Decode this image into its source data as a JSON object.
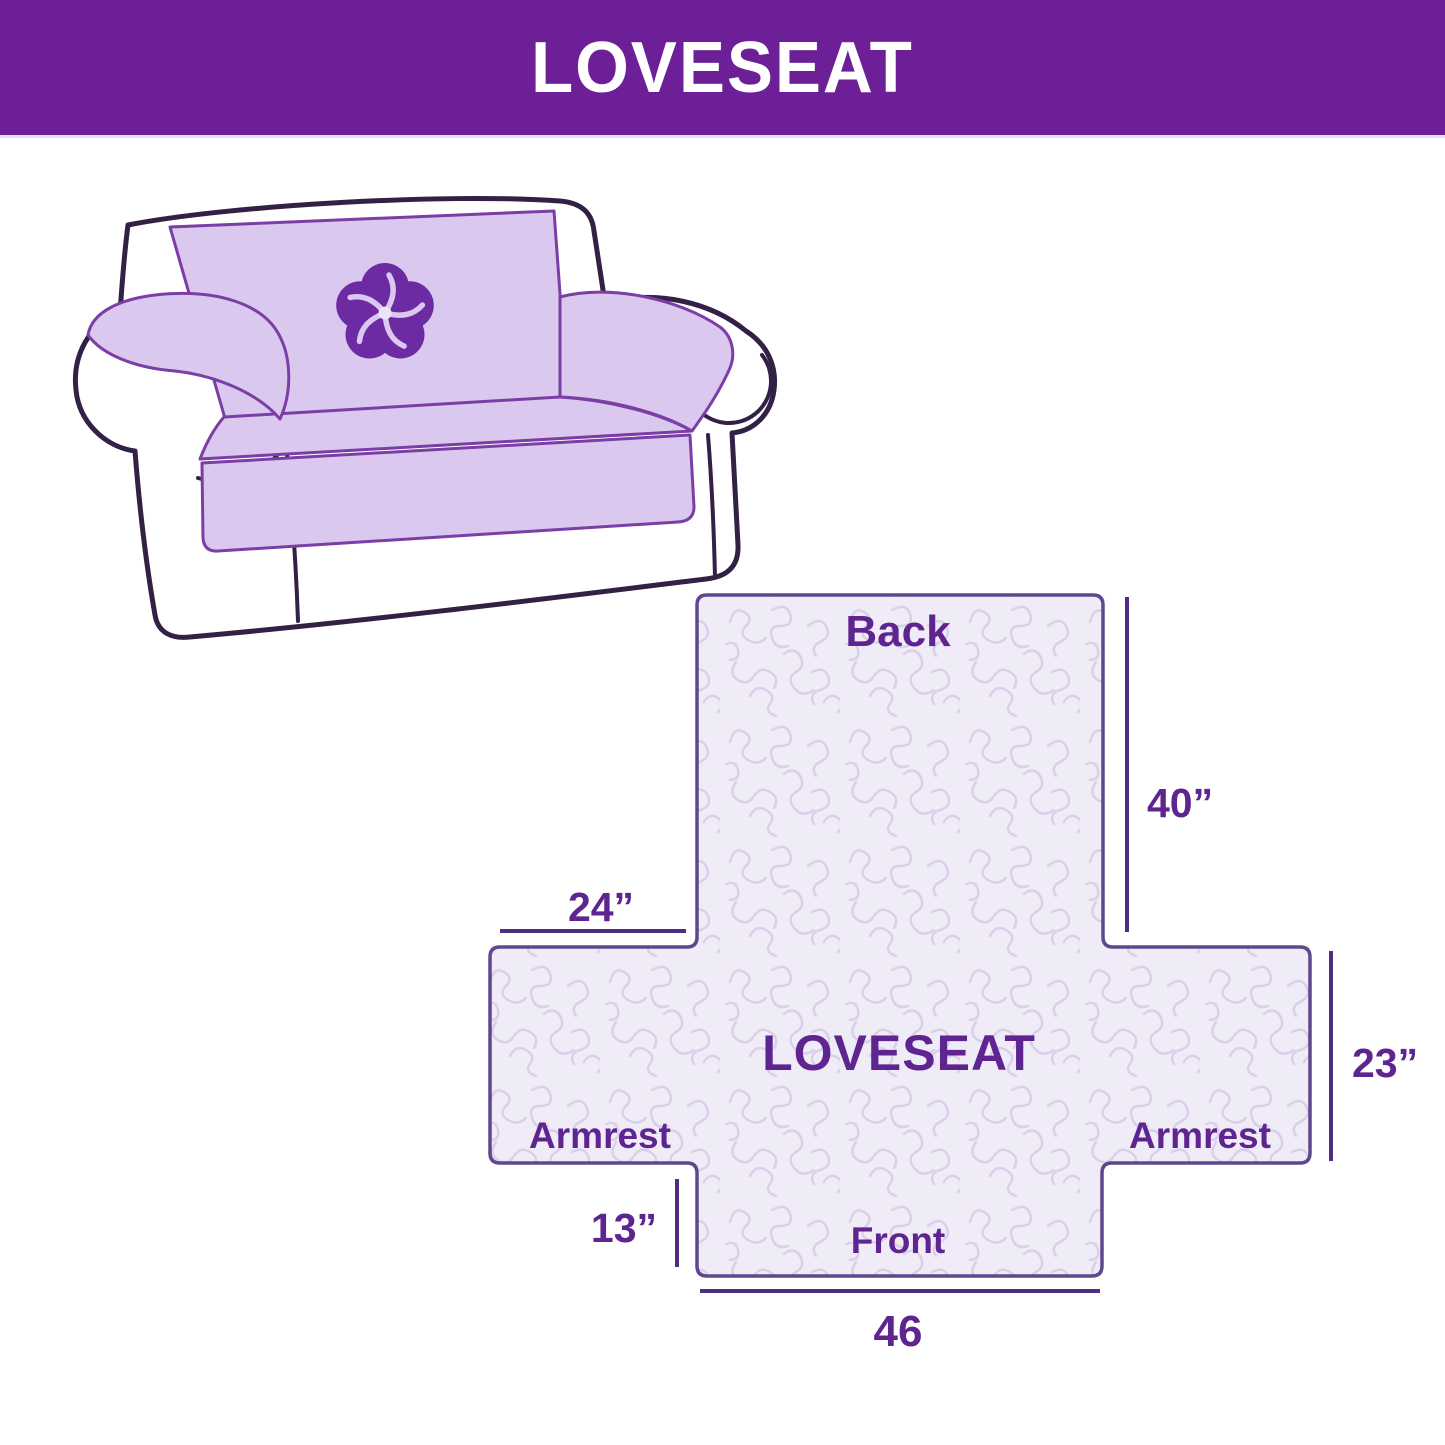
{
  "header": {
    "title": "LOVESEAT"
  },
  "colors": {
    "header_bg": "#6C1F96",
    "header_text": "#FFFFFF",
    "cover_fill": "#DBC8EE",
    "cover_stroke": "#7B3EA6",
    "sofa_outline": "#322145",
    "logo_purple": "#6C2BA2",
    "panel_fill": "#EFEBF7",
    "panel_texture": "#D8CFE8",
    "panel_outline": "#5F478E",
    "dim_line": "#4F2C82",
    "label_text": "#5E2590"
  },
  "illustration": {
    "subject": "loveseat sofa with quilted slipcover",
    "logo_icon": "pinwheel-flower-icon"
  },
  "diagram": {
    "labels": {
      "back": "Back",
      "center": "LOVESEAT",
      "armrest_left": "Armrest",
      "armrest_right": "Armrest",
      "front": "Front"
    },
    "dimensions": {
      "back_height": "40”",
      "top_left_width": "24”",
      "side_height": "23”",
      "front_drop": "13”",
      "bottom_width": "46"
    }
  }
}
